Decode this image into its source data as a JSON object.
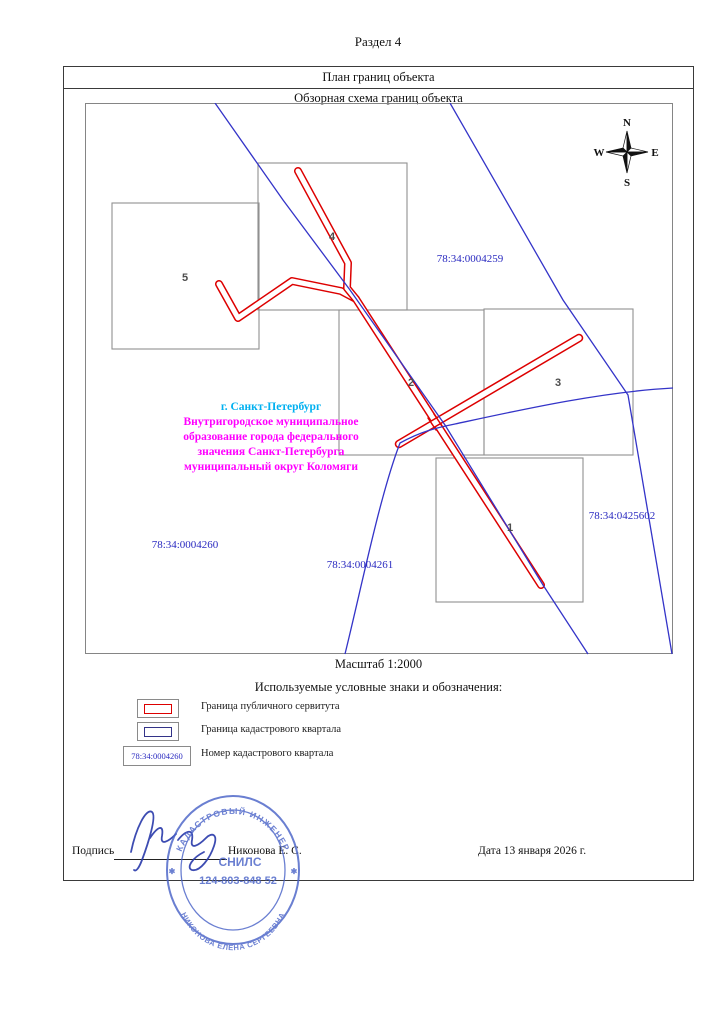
{
  "document": {
    "section_title": "Раздел 4",
    "plan_title": "План границ объекта",
    "overview_title": "Обзорная схема границ объекта",
    "scale_label": "Масштаб 1:2000"
  },
  "map": {
    "compass": {
      "north": "N",
      "east": "E",
      "south": "S",
      "west": "W"
    },
    "quarter_codes": [
      {
        "code": "78:34:0004259"
      },
      {
        "code": "78:34:0425602"
      },
      {
        "code": "78:34:0004260"
      },
      {
        "code": "78:34:0004261"
      }
    ],
    "parcel_numbers": [
      {
        "num": "1"
      },
      {
        "num": "2"
      },
      {
        "num": "3"
      },
      {
        "num": "4"
      },
      {
        "num": "5"
      }
    ],
    "location": {
      "city": "г. Санкт-Петербург",
      "municipality_lines": [
        "Внутригородское муниципальное",
        "образование города федерального",
        "значения Санкт-Петербурга",
        "муниципальный округ Коломяги"
      ]
    }
  },
  "legend": {
    "heading": "Используемые условные знаки и обозначения:",
    "items": [
      {
        "label": "Граница публичного сервитута"
      },
      {
        "label": "Граница кадастрового квартала"
      },
      {
        "label": "Номер кадастрового квартала",
        "sample_code": "78:34:0004260"
      }
    ]
  },
  "footer": {
    "signature_label": "Подпись",
    "engineer_name": "Никонова Е. С.",
    "date_text": "Дата 13 января 2026 г."
  },
  "stamp": {
    "top_text": "КАДАСТРОВЫЙ ИНЖЕНЕР",
    "bottom_text": "НИКОНОВА ЕЛЕНА СЕРГЕЕВНА",
    "center_label": "СНИЛС",
    "center_number": "124-803-848 52",
    "star": "✱"
  },
  "colors": {
    "servitude_boundary": "#dd0000",
    "quarter_boundary": "#3434c8",
    "parcel_outline": "#919191",
    "city_text": "#00b0f0",
    "municipality_text": "#ff00ff",
    "stamp_ink": "#4a63c8"
  }
}
